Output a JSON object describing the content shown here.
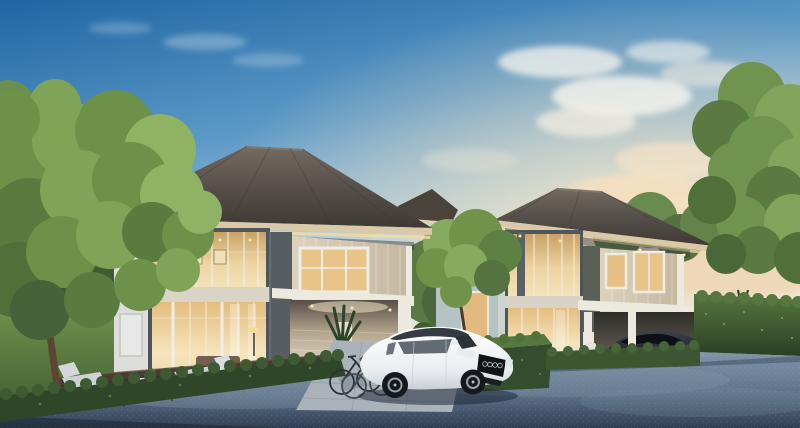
{
  "scene": {
    "title": "Photorealistic exterior rendering of two modern two-storey houses at dusk with warm lit windows, white and dark sedans, bicycles, garden deck furniture, hedges, trees and a blue-grey driveway",
    "time_of_day": "dusk",
    "objects": [
      "left-two-storey-house",
      "right-two-storey-house",
      "distant-house",
      "white-sedan",
      "dark-sedan",
      "bicycles",
      "carport",
      "deck-lounge-furniture",
      "front-hedge",
      "tall-hedge-wall",
      "box-hedge",
      "lawn",
      "driveway-road",
      "left-tree",
      "right-tree",
      "middle-tree",
      "evening-sky",
      "warm-clouds"
    ],
    "palette": {
      "sky_top": "#1e66a4",
      "sky_mid": "#79aed2",
      "sky_horizon": "#dcebee",
      "cloud_white": "#f8f5ee",
      "cloud_warm": "#f4dfc1",
      "roof_top": "#6f675d",
      "roof_bottom": "#423c36",
      "fascia": "#d9c9a9",
      "eave_glow": "#f2dba4",
      "wall_light": "#dcdedb",
      "wall_slate": "#565e62",
      "frame_slate": "#4e565b",
      "panel_beige": "#d3c7b0",
      "trim_white": "#eceade",
      "glass_warm": "#e9c488",
      "brick_lit": "#eadfcb",
      "distant_wall": "#b6c3c4",
      "hedge_top": "#577a42",
      "hedge_dark": "#344d2c",
      "lawn_light": "#6d8f4d",
      "lawn_dark": "#466334",
      "tree_light": "#8fb264",
      "tree_mid": "#6d9149",
      "tree_dark": "#4f7038",
      "trunk": "#5a4632",
      "deck_wood": "#4a3c32",
      "terrace": "#cfc0a6",
      "road_light": "#7b90a5",
      "road_dark": "#37475c",
      "paving": "#aab2ba",
      "car_white": "#f4f5f6",
      "car_black": "#23282d",
      "cushion": "#ced2d4"
    }
  }
}
